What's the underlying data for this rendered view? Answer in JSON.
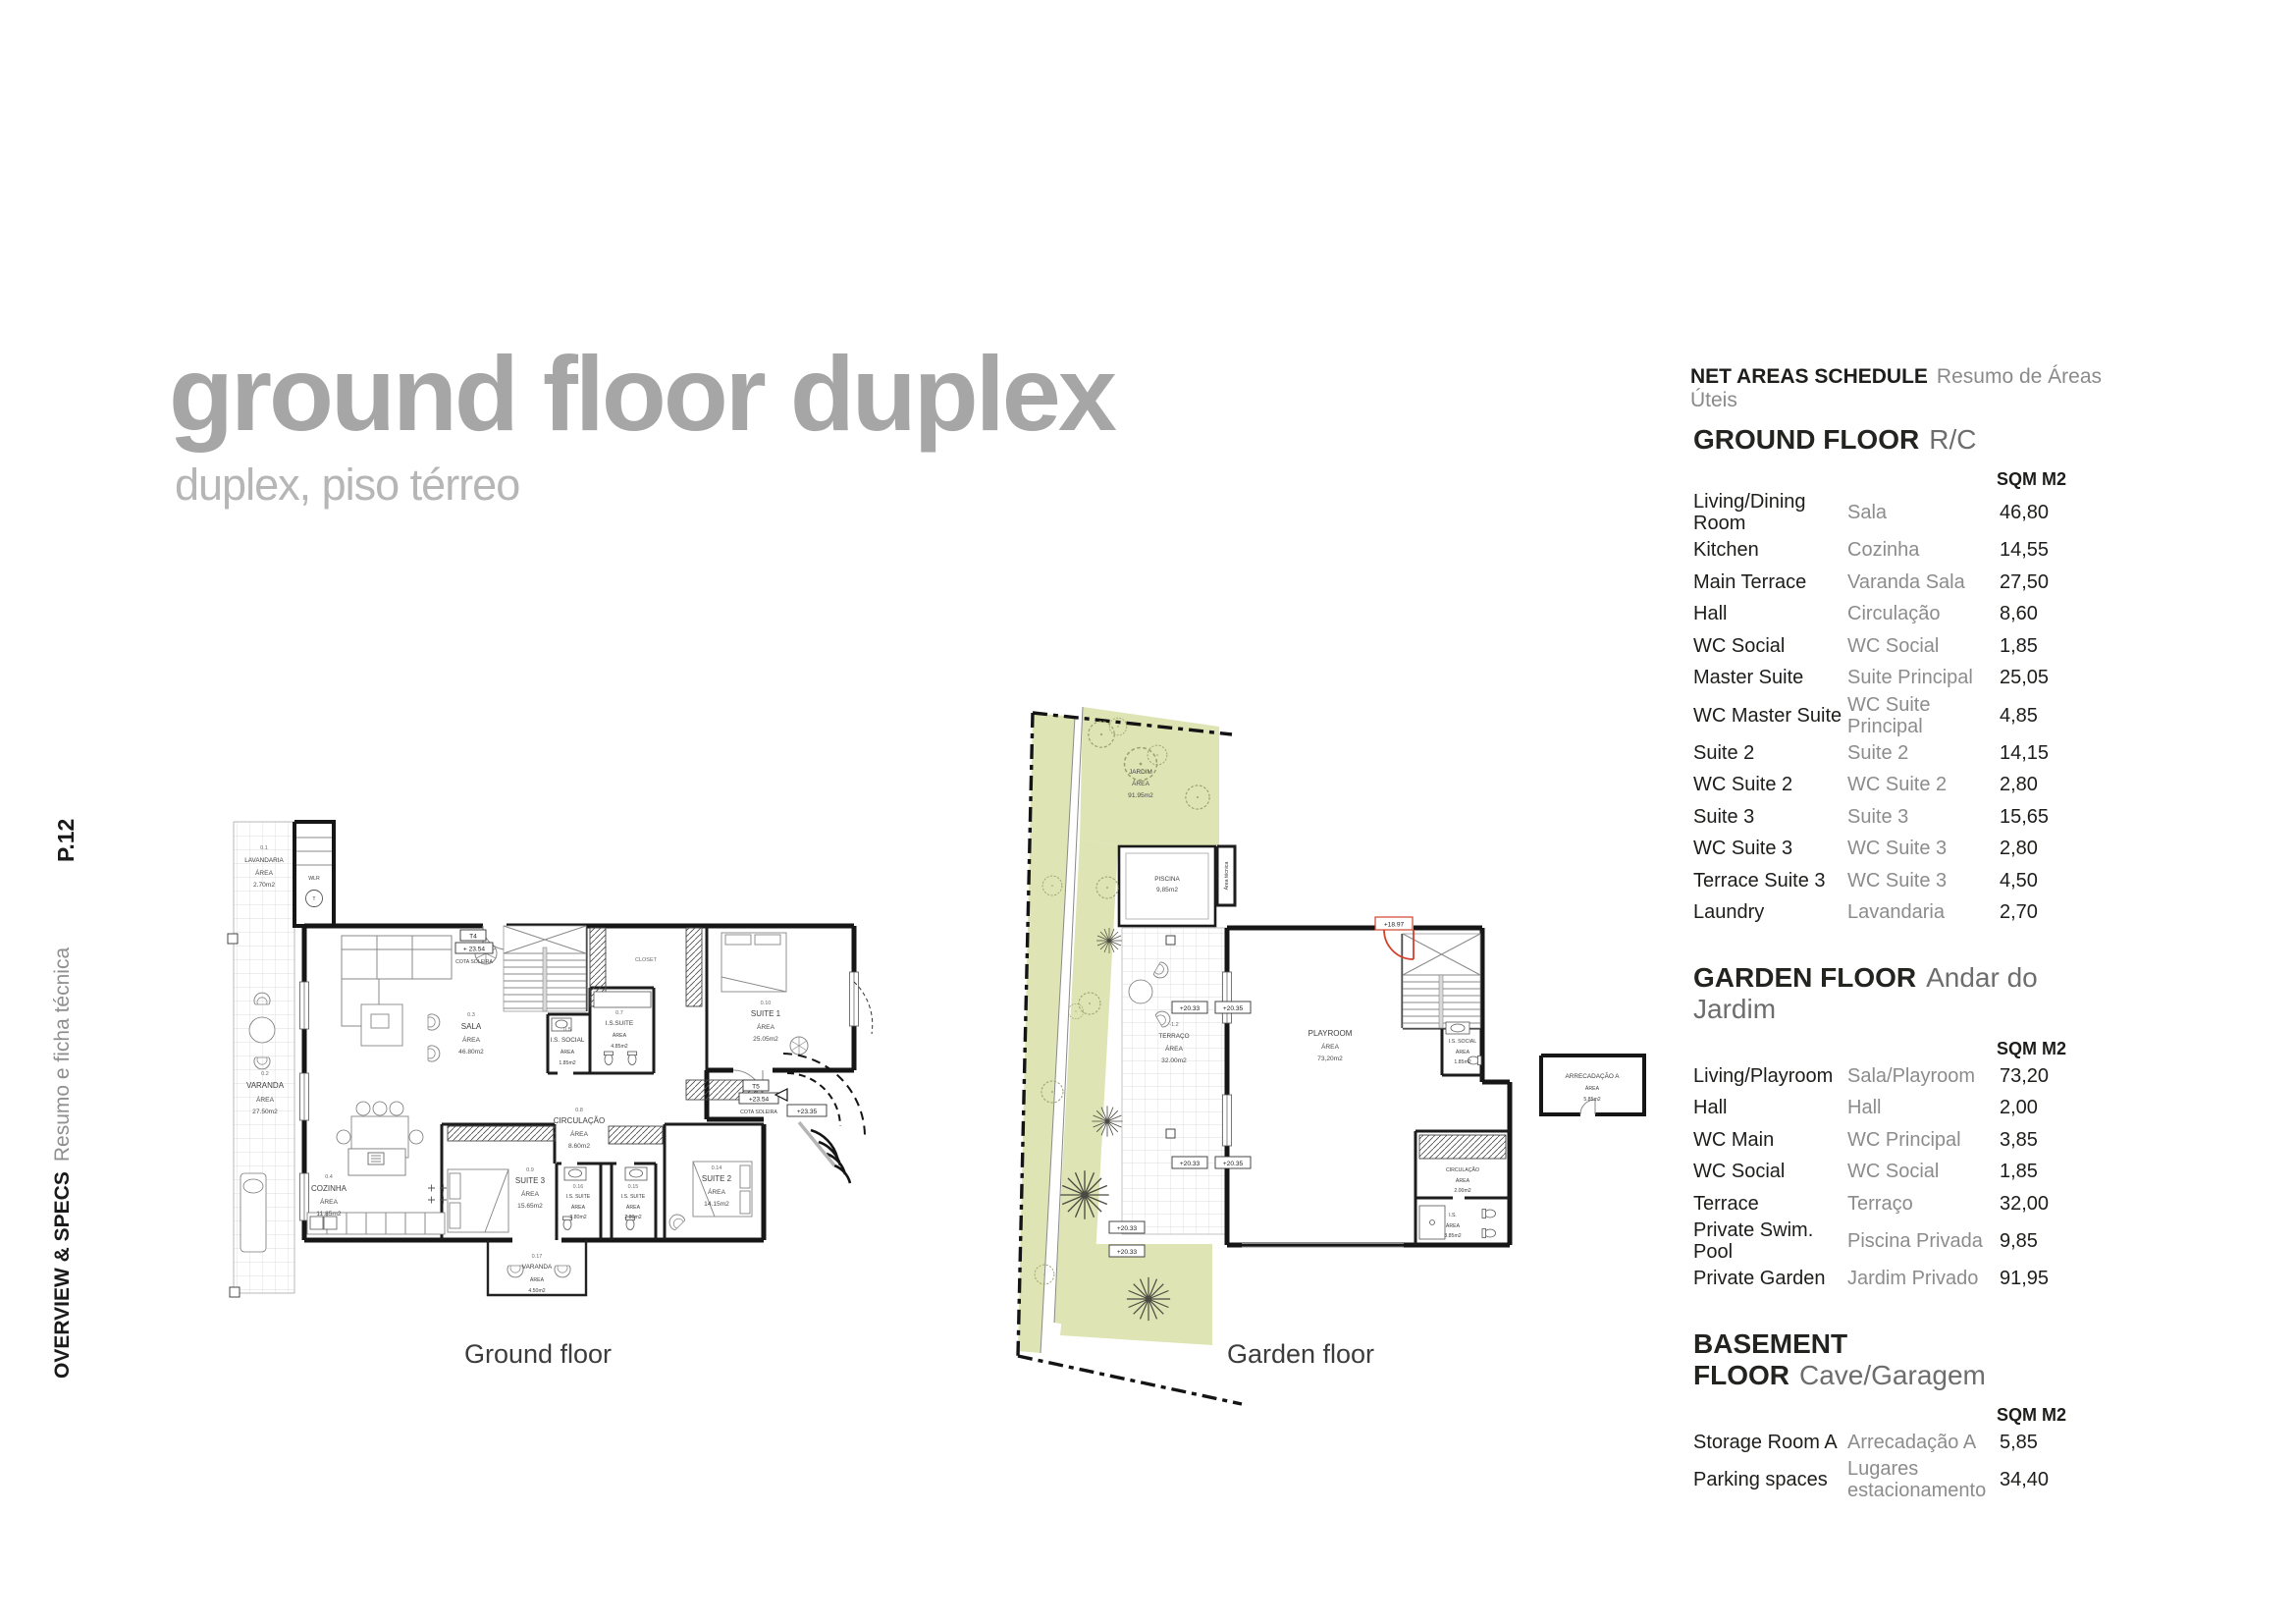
{
  "sidebar": {
    "page_number": "P.12",
    "section_en": "OVERVIEW & SPECS",
    "section_pt": "Resumo e ficha técnica"
  },
  "header": {
    "title": "ground floor duplex",
    "subtitle": "duplex, piso térreo"
  },
  "schedule": {
    "title_en": "NET AREAS SCHEDULE",
    "title_pt": "Resumo de Áreas Úteis",
    "unit_label": "SQM M2",
    "sections": [
      {
        "heading_en": "GROUND FLOOR",
        "heading_pt": "R/C",
        "rows": [
          {
            "en": "Living/Dining Room",
            "pt": "Sala",
            "sqm": "46,80"
          },
          {
            "en": "Kitchen",
            "pt": "Cozinha",
            "sqm": "14,55"
          },
          {
            "en": "Main Terrace",
            "pt": "Varanda Sala",
            "sqm": "27,50"
          },
          {
            "en": "Hall",
            "pt": "Circulação",
            "sqm": "8,60"
          },
          {
            "en": "WC Social",
            "pt": "WC Social",
            "sqm": "1,85"
          },
          {
            "en": "Master Suite",
            "pt": "Suite Principal",
            "sqm": "25,05"
          },
          {
            "en": "WC Master Suite",
            "pt": "WC Suite Principal",
            "sqm": "4,85"
          },
          {
            "en": "Suite 2",
            "pt": "Suite 2",
            "sqm": "14,15"
          },
          {
            "en": "WC Suite 2",
            "pt": "WC Suite 2",
            "sqm": "2,80"
          },
          {
            "en": "Suite 3",
            "pt": "Suite 3",
            "sqm": "15,65"
          },
          {
            "en": "WC Suite 3",
            "pt": "WC Suite 3",
            "sqm": "2,80"
          },
          {
            "en": "Terrace Suite 3",
            "pt": "WC Suite 3",
            "sqm": "4,50"
          },
          {
            "en": "Laundry",
            "pt": "Lavandaria",
            "sqm": "2,70"
          }
        ]
      },
      {
        "heading_en": "GARDEN FLOOR",
        "heading_pt": "Andar do Jardim",
        "rows": [
          {
            "en": "Living/Playroom",
            "pt": "Sala/Playroom",
            "sqm": "73,20"
          },
          {
            "en": "Hall",
            "pt": "Hall",
            "sqm": "2,00"
          },
          {
            "en": "WC Main",
            "pt": "WC Principal",
            "sqm": "3,85"
          },
          {
            "en": "WC Social",
            "pt": "WC Social",
            "sqm": "1,85"
          },
          {
            "en": "Terrace",
            "pt": "Terraço",
            "sqm": "32,00"
          },
          {
            "en": "Private Swim. Pool",
            "pt": "Piscina Privada",
            "sqm": "9,85"
          },
          {
            "en": "Private Garden",
            "pt": "Jardim Privado",
            "sqm": "91,95"
          }
        ]
      },
      {
        "heading_en": "BASEMENT FLOOR",
        "heading_pt": "Cave/Garagem",
        "rows": [
          {
            "en": "Storage Room A",
            "pt": "Arrecadação A",
            "sqm": "5,85"
          },
          {
            "en": "Parking spaces",
            "pt": "Lugares estacionamento",
            "sqm": "34,40"
          }
        ]
      }
    ]
  },
  "plans": {
    "ground": {
      "caption": "Ground floor",
      "closet_label": "CLOSET",
      "wlr": "WLR",
      "t_label": "T",
      "t4": {
        "unit": "T4",
        "cota": "+ 23.54",
        "cota_label": "COTA SOLEIRA"
      },
      "t5": {
        "unit": "T5",
        "cota": "+23.54",
        "cota_label": "COTA SOLEIRA",
        "level": "+23.35"
      },
      "rooms": [
        {
          "code": "0.1",
          "name": "LAVANDARIA",
          "area_word": "ÁREA",
          "value": "2.70m2"
        },
        {
          "code": "0.2",
          "name": "VARANDA",
          "area_word": "ÁREA",
          "value": "27.50m2"
        },
        {
          "code": "0.3",
          "name": "SALA",
          "area_word": "ÁREA",
          "value": "46.80m2"
        },
        {
          "code": "0.4",
          "name": "COZINHA",
          "area_word": "ÁREA",
          "value": "11.85m2"
        },
        {
          "code": "0.5",
          "name": "I.S. SOCIAL",
          "area_word": "ÁREA",
          "value": "1.85m2"
        },
        {
          "code": "0.7",
          "name": "I.S.SUITE",
          "area_word": "ÁREA",
          "value": "4.85m2"
        },
        {
          "code": "0.8",
          "name": "CIRCULAÇÃO",
          "area_word": "ÁREA",
          "value": "8.60m2"
        },
        {
          "code": "0.9",
          "name": "SUITE 3",
          "area_word": "ÁREA",
          "value": "15.65m2"
        },
        {
          "code": "0.10",
          "name": "SUITE 1",
          "area_word": "ÁREA",
          "value": "25.05m2"
        },
        {
          "code": "0.14",
          "name": "SUITE 2",
          "area_word": "ÁREA",
          "value": "14.15m2"
        },
        {
          "code": "0.15",
          "name": "I.S. SUITE",
          "area_word": "ÁREA",
          "value": "2.80m2"
        },
        {
          "code": "0.16",
          "name": "I.S. SUITE",
          "area_word": "ÁREA",
          "value": "2.80m2"
        },
        {
          "code": "0.17",
          "name": "VARANDA",
          "area_word": "ÁREA",
          "value": "4.50m2"
        }
      ]
    },
    "garden": {
      "caption": "Garden floor",
      "markers": {
        "m2033": "+20.33",
        "m2035": "+20.35",
        "m1897": "+18.97"
      },
      "rooms": [
        {
          "name": "JARDIM",
          "area_word": "ÁREA",
          "value": "91.95m2"
        },
        {
          "name": "PISCINA",
          "value": "9,85m2"
        },
        {
          "name": "Área técnica"
        },
        {
          "code": "-1.2",
          "name": "TERRAÇO",
          "area_word": "ÁREA",
          "value": "32.00m2"
        },
        {
          "name": "PLAYROOM",
          "area_word": "ÁREA",
          "value": "73,20m2"
        },
        {
          "name": "I.S. SOCIAL",
          "area_word": "ÁREA",
          "value": "1.85m2"
        },
        {
          "name": "CIRCULAÇÃO",
          "area_word": "ÁREA",
          "value": "2.00m2"
        },
        {
          "name": "I.S.",
          "area_word": "ÁREA",
          "value": "3.85m2"
        },
        {
          "name": "ARRECADAÇÃO A",
          "area_word": "ÁREA",
          "value": "5.85m2"
        }
      ]
    }
  },
  "colors": {
    "accent_green": "#dee4b3",
    "door_red": "#d2422c",
    "title_gray": "#a6a6a6"
  }
}
